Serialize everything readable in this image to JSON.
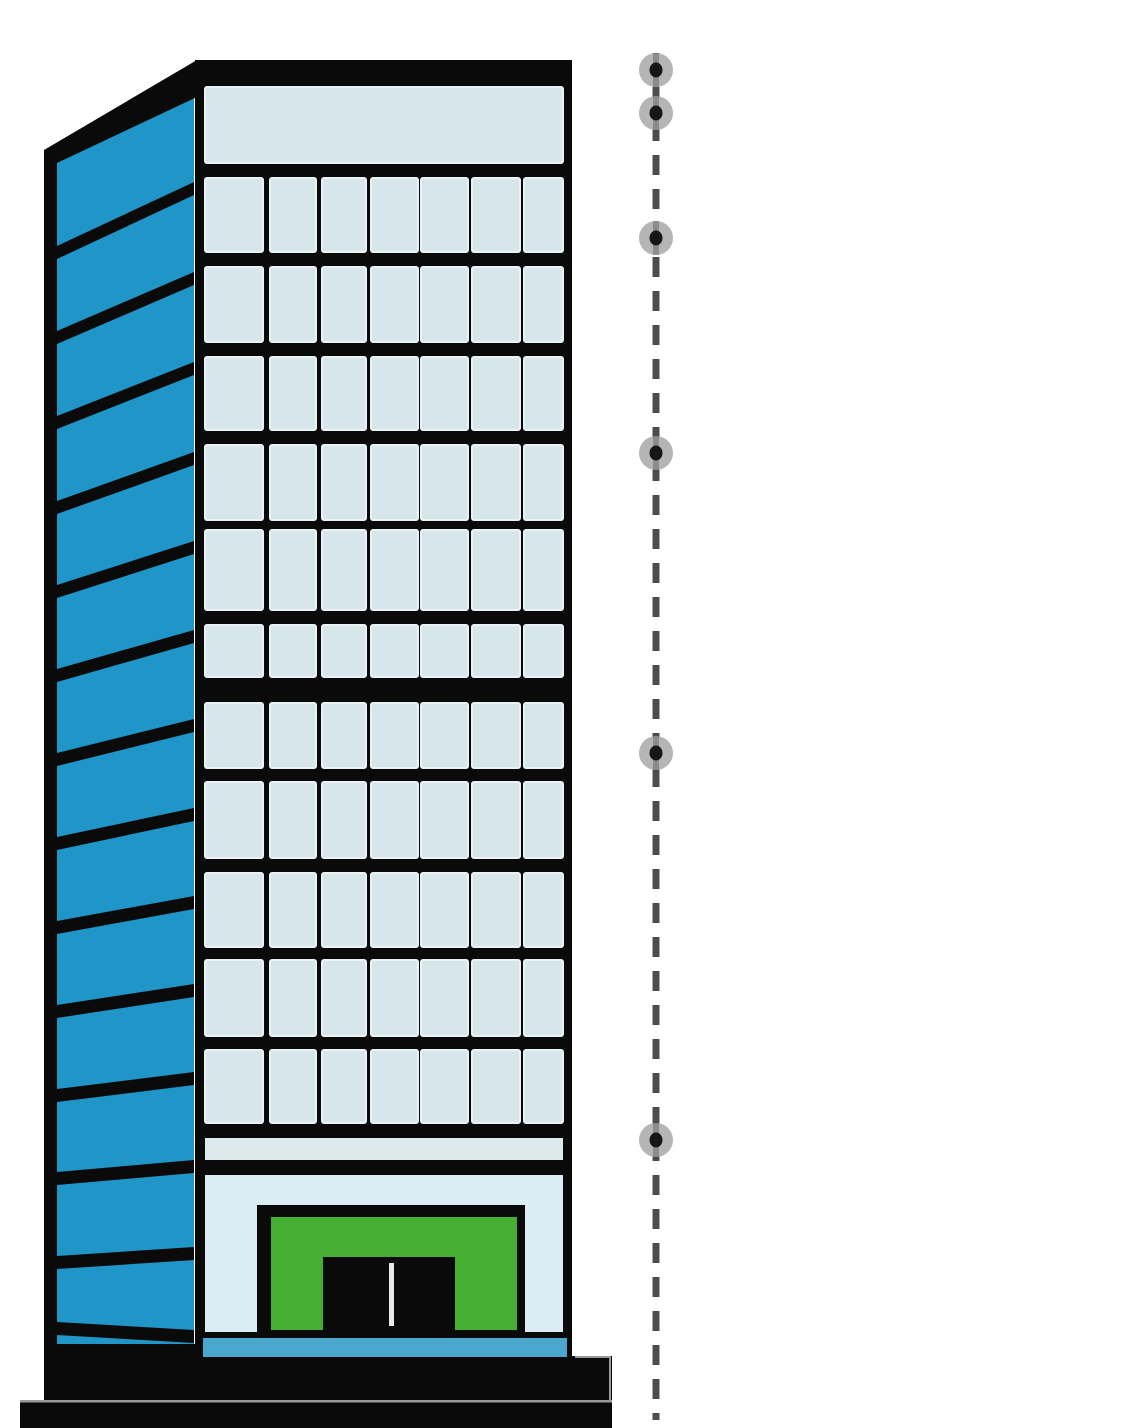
{
  "canvas": {
    "width": 1136,
    "height": 1428,
    "background": "#ffffff"
  },
  "palette": {
    "outline": "#0a0a0a",
    "side_blue": "#2095c8",
    "window_blue": "#d6e6ea",
    "window_inner_edge": "#e9f2f5",
    "strip_blue": "#dceaee",
    "entrance_blue": "#dbedf2",
    "trim_blue": "#4aa8ce",
    "awning_green": "#46ae33",
    "door_black": "#0a0a0a",
    "handle_white": "#e9e9e9",
    "dash_gray": "#4d4d4d",
    "marker_gray": "#b5b5b5",
    "marker_dot": "#161616",
    "line_through_marker": "#2d2d2d",
    "edge_highlight": "#9a9a9a"
  },
  "building": {
    "side": {
      "edge_band": {
        "x": 44,
        "y": 150,
        "w": 13,
        "h": 1252
      },
      "face": [
        [
          57,
          160
        ],
        [
          194,
          92
        ],
        [
          194,
          1357
        ],
        [
          57,
          1347
        ]
      ],
      "stripe_thickness": 13,
      "stripes": [
        [
          182,
          246
        ],
        [
          272,
          331
        ],
        [
          362,
          416
        ],
        [
          452,
          501
        ],
        [
          541,
          585
        ],
        [
          630,
          669
        ],
        [
          719,
          753
        ],
        [
          808,
          837
        ],
        [
          896,
          921
        ],
        [
          984,
          1005
        ],
        [
          1072,
          1089
        ],
        [
          1160,
          1172
        ],
        [
          1247,
          1256
        ],
        [
          1330,
          1322
        ]
      ],
      "right_x": 194,
      "left_x": 57
    },
    "roof": [
      [
        44,
        150
      ],
      [
        197,
        60
      ],
      [
        197,
        97
      ],
      [
        57,
        163
      ],
      [
        44,
        163
      ]
    ],
    "front": {
      "frame": {
        "x": 195,
        "y": 60,
        "w": 377,
        "h": 1300
      },
      "interior": {
        "x": 205,
        "right": 563
      },
      "top_panel": {
        "y": 87,
        "h": 76
      },
      "window_cols": [
        {
          "x": 205,
          "w": 58
        },
        {
          "x": 270,
          "w": 46
        },
        {
          "x": 322,
          "w": 44
        },
        {
          "x": 371,
          "w": 47
        },
        {
          "x": 421,
          "w": 47
        },
        {
          "x": 472,
          "w": 48
        },
        {
          "x": 524,
          "w": 39
        }
      ],
      "window_rows": [
        {
          "y": 178,
          "h": 74
        },
        {
          "y": 267,
          "h": 75
        },
        {
          "y": 357,
          "h": 73
        },
        {
          "y": 445,
          "h": 75
        },
        {
          "y": 530,
          "h": 80
        },
        {
          "y": 625,
          "h": 52
        },
        {
          "y": 703,
          "h": 65
        },
        {
          "y": 782,
          "h": 76
        },
        {
          "y": 873,
          "h": 74
        },
        {
          "y": 960,
          "h": 76
        },
        {
          "y": 1050,
          "h": 73
        }
      ],
      "spandrel_strip": {
        "y": 1138,
        "h": 22
      },
      "entrance_panel": {
        "y": 1175,
        "h": 157
      },
      "base_trim": {
        "x": 203,
        "y": 1338,
        "w": 364,
        "h": 19
      }
    },
    "entrance": {
      "frame": {
        "x": 257,
        "y": 1205,
        "w": 268,
        "h": 127
      },
      "awning": {
        "x": 271,
        "y": 1217,
        "w": 246,
        "h": 113
      },
      "door": {
        "x": 323,
        "y": 1257,
        "w": 132,
        "h": 73
      },
      "handle": {
        "x": 389,
        "y": 1263,
        "w": 5,
        "h": 63
      }
    },
    "base": {
      "x": 44,
      "y": 1344,
      "w": 528,
      "h": 84
    },
    "base_step": {
      "x": 567,
      "y": 1356,
      "w": 45,
      "h": 72
    },
    "ground_bar": {
      "x": 20,
      "y": 1402,
      "w": 592,
      "h": 26
    },
    "ground_line": {
      "x": 20,
      "y": 1400,
      "w": 592,
      "h": 2.5
    },
    "step_outline": {
      "x1": 575,
      "y1": 1357,
      "x2": 610,
      "y2": 1400
    }
  },
  "drop_indicator": {
    "line": {
      "x": 656,
      "y1": 53,
      "y2": 1420,
      "width": 7,
      "dash": "20 14"
    },
    "markers": {
      "outer_r": 17,
      "dot_rx": 6.5,
      "dot_ry": 7.5,
      "y_positions": [
        70,
        113,
        238,
        453,
        753,
        1140
      ]
    }
  }
}
